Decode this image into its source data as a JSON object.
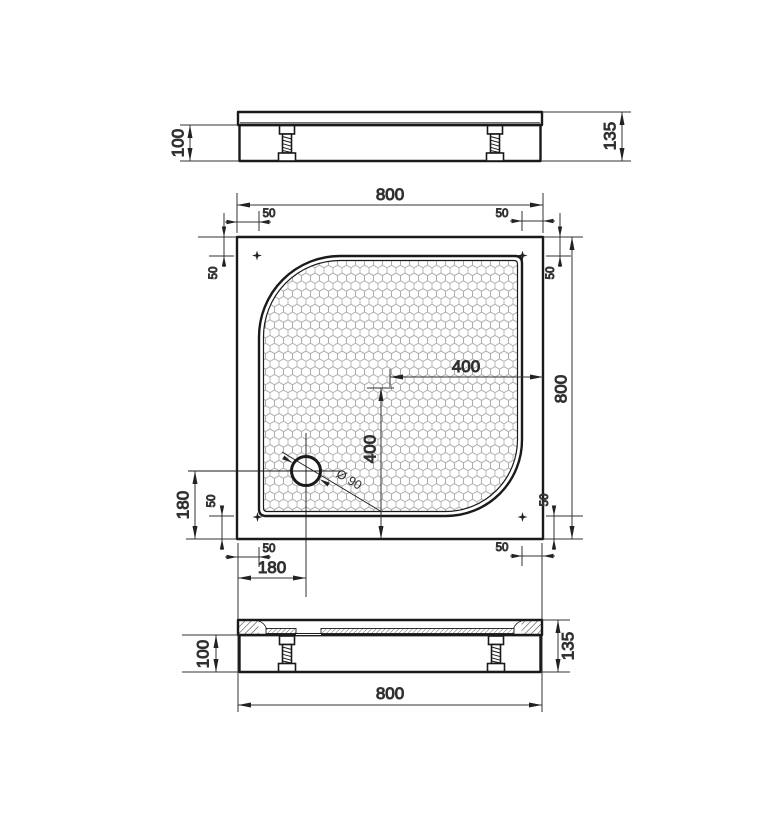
{
  "drawing": {
    "type": "technical-dimension-drawing",
    "subject": "square shower tray with rounded anti-slip basin and adjustable feet",
    "colors": {
      "background": "#ffffff",
      "outline": "#1a1a1a",
      "dimension_lines": "#333333",
      "text": "#2b2b2b",
      "hex_pattern": "#ababab"
    },
    "labels": {
      "width_top": "800",
      "height_right": "800",
      "width_bottom": "800",
      "edge_offset": "50",
      "center_from_right": "400",
      "center_from_bottom": "400",
      "drain_from_left": "180",
      "drain_from_bottom": "180",
      "drain_diameter": "Ø 90",
      "body_height": "100",
      "total_height": "135"
    }
  }
}
